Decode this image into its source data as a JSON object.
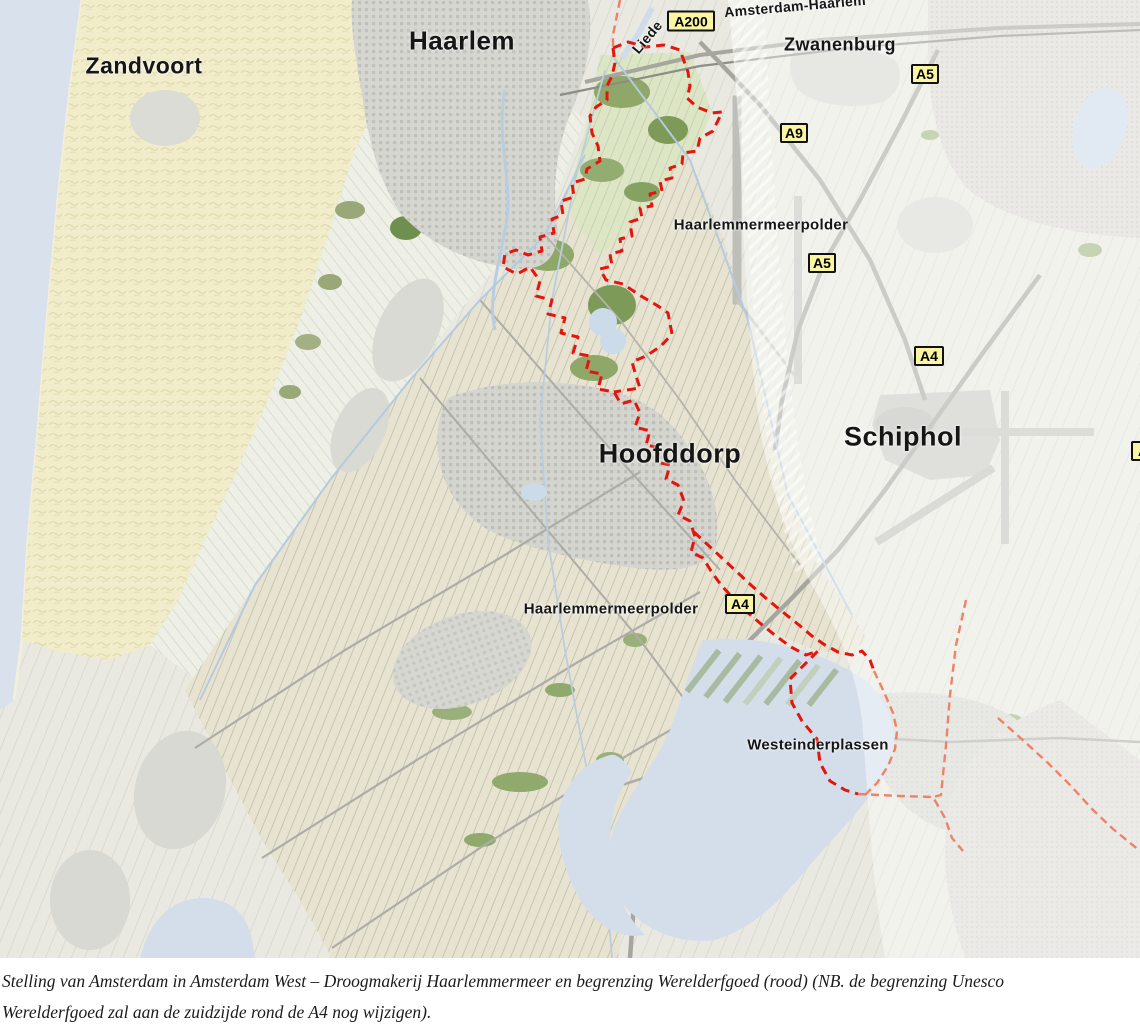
{
  "map": {
    "city_labels": {
      "zandvoort": "Zandvoort",
      "haarlem": "Haarlem",
      "zwanenburg": "Zwanenburg",
      "hoofddorp": "Hoofddorp",
      "schiphol": "Schiphol"
    },
    "area_labels": {
      "haarlemmermeerpolder_north": "Haarlemmermeerpolder",
      "haarlemmermeerpolder_south": "Haarlemmermeerpolder",
      "westeinderplassen": "Westeinderplassen",
      "liede": "Liede",
      "railway_corridor": "Amsterdam-Haarlem"
    },
    "road_badges": {
      "a200": "A200",
      "a5_north": "A5",
      "a9": "A9",
      "a5_mid": "A5",
      "a4_north": "A4",
      "a4_south": "A4",
      "a4_edge_partial": "A4"
    },
    "colors": {
      "heritage_boundary_red": "#e5140c",
      "secondary_boundary_orange": "#ee8266",
      "road_badge_yellow": "#faf5a2",
      "sea_blue": "#d8e1ec",
      "lake_blue": "#d3deea",
      "dune_cream": "#f1ecca",
      "polder_beige": "#e8e3d0",
      "urban_gray": "#d6d6d0"
    }
  },
  "caption": {
    "line1": "Stelling van Amsterdam in Amsterdam West – Droogmakerij Haarlemmermeer en begrenzing Werelderfgoed (rood) (NB. de begrenzing Unesco",
    "line2": "Werelderfgoed zal aan de zuidzijde rond de A4 nog wijzigen)."
  }
}
